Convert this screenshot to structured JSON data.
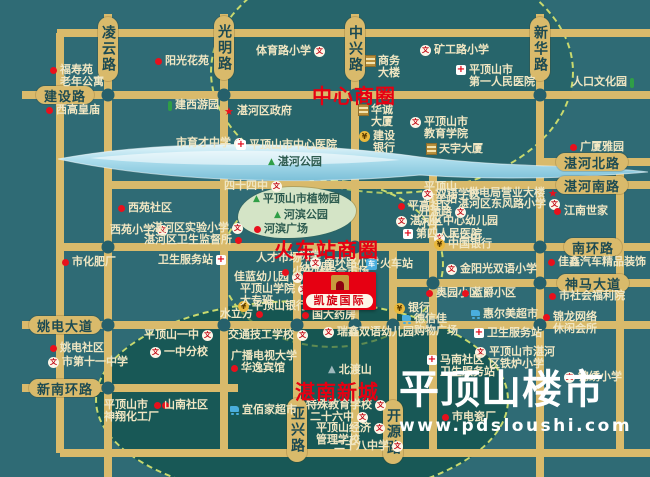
{
  "colors": {
    "background": "#2f6b75",
    "road": "#d9ba6b",
    "road_text": "#1c4a52",
    "label_text": "#f0e6c2",
    "accent_red": "#e60012",
    "river": "#a8d8ea",
    "park_green": "#d4e4c6",
    "zone_dash": "#c9da6e"
  },
  "project": {
    "name": "凯旋国际"
  },
  "logo": {
    "title": "平顶山楼市",
    "url": "www.pdsloushi.com"
  },
  "business_zones": [
    {
      "label": "中心商圈",
      "x": 312,
      "y": 80
    },
    {
      "label": "火车站商圈",
      "x": 274,
      "y": 234
    },
    {
      "label": "湛南新城",
      "x": 295,
      "y": 376
    }
  ],
  "road_labels": [
    {
      "text": "凌云路",
      "dir": "v",
      "x": 108,
      "y": 49
    },
    {
      "text": "光明路",
      "dir": "v",
      "x": 224,
      "y": 48
    },
    {
      "text": "中兴路",
      "dir": "v",
      "x": 355,
      "y": 49
    },
    {
      "text": "新华路",
      "dir": "v",
      "x": 540,
      "y": 49
    },
    {
      "text": "亚兴路",
      "dir": "v",
      "x": 297,
      "y": 430
    },
    {
      "text": "开源路",
      "dir": "v",
      "x": 393,
      "y": 432
    },
    {
      "text": "建设路",
      "dir": "h",
      "x": 65,
      "y": 95
    },
    {
      "text": "姚电大道",
      "dir": "h",
      "x": 65,
      "y": 325
    },
    {
      "text": "新南环路",
      "dir": "h",
      "x": 65,
      "y": 388
    },
    {
      "text": "湛河北路",
      "dir": "h",
      "x": 592,
      "y": 162
    },
    {
      "text": "湛河南路",
      "dir": "h",
      "x": 592,
      "y": 185
    },
    {
      "text": "南环路",
      "dir": "h",
      "x": 593,
      "y": 247
    },
    {
      "text": "神马大道",
      "dir": "h",
      "x": 593,
      "y": 283
    }
  ],
  "landmarks": [
    {
      "x": 155,
      "y": 55,
      "icon": "dot",
      "lines": [
        "阳光花苑"
      ]
    },
    {
      "x": 50,
      "y": 64,
      "icon": "dot",
      "lines": [
        "福寿苑",
        "老年公寓"
      ]
    },
    {
      "x": 46,
      "y": 104,
      "icon": "dot",
      "lines": [
        "西高皇庙"
      ]
    },
    {
      "x": 168,
      "y": 99,
      "icon": "park",
      "lines": [
        "建西游园"
      ]
    },
    {
      "x": 176,
      "y": 137,
      "icon": "school",
      "side": "r",
      "lines": [
        "市育才中学"
      ]
    },
    {
      "x": 224,
      "y": 105,
      "icon": "star",
      "lines": [
        "湛河区政府"
      ]
    },
    {
      "x": 256,
      "y": 45,
      "icon": "school",
      "side": "r",
      "lines": [
        "体育路小学"
      ]
    },
    {
      "x": 236,
      "y": 139,
      "icon": "hosp",
      "lines": [
        "平顶山市中心医院"
      ]
    },
    {
      "x": 366,
      "y": 55,
      "icon": "bldg",
      "lines": [
        "商务",
        "大楼"
      ]
    },
    {
      "x": 359,
      "y": 104,
      "icon": "bldg",
      "lines": [
        "华诚",
        "大厦"
      ]
    },
    {
      "x": 359,
      "y": 130,
      "icon": "bank",
      "lines": [
        "建设",
        "银行"
      ]
    },
    {
      "x": 410,
      "y": 116,
      "icon": "school",
      "lines": [
        "平顶山市",
        "教育学院"
      ]
    },
    {
      "x": 427,
      "y": 143,
      "icon": "bldg",
      "lines": [
        "天宇大厦"
      ]
    },
    {
      "x": 420,
      "y": 44,
      "icon": "school",
      "lines": [
        "矿工路小学"
      ]
    },
    {
      "x": 456,
      "y": 64,
      "icon": "hosp",
      "lines": [
        "平顶山市",
        "第一人民医院"
      ]
    },
    {
      "x": 572,
      "y": 76,
      "icon": "park",
      "side": "r",
      "lines": [
        "人口文化园"
      ]
    },
    {
      "x": 570,
      "y": 141,
      "icon": "dot",
      "lines": [
        "广厦雅园"
      ]
    },
    {
      "x": 118,
      "y": 202,
      "icon": "dot",
      "lines": [
        "西苑社区"
      ]
    },
    {
      "x": 110,
      "y": 224,
      "icon": "school",
      "side": "r",
      "lines": [
        "西苑小学"
      ]
    },
    {
      "x": 152,
      "y": 222,
      "icon": "school",
      "side": "r",
      "lines": [
        "湛河区实验小学"
      ]
    },
    {
      "x": 144,
      "y": 234,
      "icon": "dot",
      "side": "r",
      "lines": [
        "湛河区卫生监督所"
      ]
    },
    {
      "x": 158,
      "y": 254,
      "icon": "hosp",
      "side": "r",
      "lines": [
        "卫生服务站"
      ]
    },
    {
      "x": 62,
      "y": 256,
      "icon": "dot",
      "lines": [
        "市化肥厂"
      ]
    },
    {
      "x": 224,
      "y": 180,
      "icon": "school",
      "side": "r",
      "lines": [
        "四十四中"
      ]
    },
    {
      "x": 268,
      "y": 156,
      "icon": "tree",
      "dark": true,
      "lines": [
        "湛河公园"
      ]
    },
    {
      "x": 253,
      "y": 193,
      "icon": "tree",
      "dark": true,
      "lines": [
        "平顶山市植物园"
      ]
    },
    {
      "x": 274,
      "y": 209,
      "icon": "tree",
      "dark": true,
      "lines": [
        "河滨公园"
      ]
    },
    {
      "x": 254,
      "y": 223,
      "icon": "dot",
      "dark": true,
      "lines": [
        "河滨广场"
      ]
    },
    {
      "x": 424,
      "y": 181,
      "icon": "none",
      "lines": [
        "平顶山",
        "汽车站"
      ]
    },
    {
      "x": 419,
      "y": 206,
      "icon": "school",
      "side": "r",
      "lines": [
        "开源路",
        "小学"
      ]
    },
    {
      "x": 434,
      "y": 232,
      "icon": "school",
      "lines": [
        "十三中"
      ]
    },
    {
      "x": 422,
      "y": 188,
      "icon": "school",
      "lines": [
        "双语学校"
      ]
    },
    {
      "x": 398,
      "y": 200,
      "icon": "dot",
      "lines": [
        "平高社区"
      ]
    },
    {
      "x": 468,
      "y": 187,
      "icon": "star",
      "side": "r",
      "lines": [
        "供电局营业大楼"
      ]
    },
    {
      "x": 458,
      "y": 198,
      "icon": "school",
      "side": "r",
      "lines": [
        "湛河区东风路小学"
      ]
    },
    {
      "x": 396,
      "y": 215,
      "icon": "school",
      "lines": [
        "湛河区中心幼儿园"
      ]
    },
    {
      "x": 403,
      "y": 228,
      "icon": "hosp",
      "lines": [
        "第四人民医院"
      ]
    },
    {
      "x": 434,
      "y": 238,
      "icon": "bank",
      "lines": [
        "中国银行"
      ]
    },
    {
      "x": 554,
      "y": 205,
      "icon": "dot",
      "lines": [
        "江南世家"
      ]
    },
    {
      "x": 446,
      "y": 263,
      "icon": "school",
      "lines": [
        "金阳光双语小学"
      ]
    },
    {
      "x": 548,
      "y": 256,
      "icon": "dot",
      "lines": [
        "佳鑫汽车精品装饰"
      ]
    },
    {
      "x": 426,
      "y": 287,
      "icon": "dot",
      "lines": [
        "奥园小区"
      ]
    },
    {
      "x": 462,
      "y": 287,
      "icon": "dot",
      "lines": [
        "蓝爵小区"
      ]
    },
    {
      "x": 549,
      "y": 290,
      "icon": "dot",
      "lines": [
        "市社会福利院"
      ]
    },
    {
      "x": 543,
      "y": 311,
      "icon": "dot",
      "lines": [
        "锦龙网络",
        "休闲会所"
      ]
    },
    {
      "x": 471,
      "y": 308,
      "icon": "cart",
      "lines": [
        "惠尔美超市"
      ]
    },
    {
      "x": 474,
      "y": 327,
      "icon": "hosp",
      "lines": [
        "卫生服务站"
      ]
    },
    {
      "x": 475,
      "y": 346,
      "icon": "school",
      "lines": [
        "平顶山市湛河",
        "区铁炉小学"
      ]
    },
    {
      "x": 427,
      "y": 354,
      "icon": "hosp",
      "lines": [
        "马南社区",
        "卫生服务站"
      ]
    },
    {
      "x": 564,
      "y": 371,
      "icon": "school",
      "lines": [
        "锦绣小学"
      ]
    },
    {
      "x": 442,
      "y": 411,
      "icon": "dot",
      "lines": [
        "市电瓷厂"
      ]
    },
    {
      "x": 394,
      "y": 302,
      "icon": "bank",
      "lines": [
        "银行"
      ]
    },
    {
      "x": 402,
      "y": 313,
      "icon": "cart",
      "lines": [
        "德信佳",
        "购物广场"
      ]
    },
    {
      "x": 220,
      "y": 308,
      "icon": "dot",
      "side": "r",
      "lines": [
        "水立方"
      ]
    },
    {
      "x": 238,
      "y": 300,
      "icon": "bank",
      "lines": [
        "平顶山银行"
      ]
    },
    {
      "x": 302,
      "y": 309,
      "icon": "dot",
      "lines": [
        "国大药房"
      ]
    },
    {
      "x": 228,
      "y": 329,
      "icon": "school",
      "side": "r",
      "lines": [
        "交通技工学校"
      ]
    },
    {
      "x": 323,
      "y": 326,
      "icon": "school",
      "lines": [
        "瑞鑫双语幼儿园"
      ]
    },
    {
      "x": 231,
      "y": 350,
      "icon": "none",
      "lines": [
        "广播电视大学"
      ]
    },
    {
      "x": 231,
      "y": 362,
      "icon": "dot",
      "lines": [
        "华逸宾馆"
      ]
    },
    {
      "x": 328,
      "y": 364,
      "icon": "mtn",
      "lines": [
        "北渡山"
      ]
    },
    {
      "x": 306,
      "y": 399,
      "icon": "school",
      "side": "r",
      "lines": [
        "特殊教育学校"
      ]
    },
    {
      "x": 310,
      "y": 411,
      "icon": "school",
      "side": "r",
      "lines": [
        "二十六中"
      ]
    },
    {
      "x": 316,
      "y": 422,
      "icon": "school",
      "side": "r",
      "lines": [
        "平顶山经济",
        "管理学校"
      ]
    },
    {
      "x": 334,
      "y": 440,
      "icon": "school",
      "side": "r",
      "lines": [
        "二十八中学"
      ]
    },
    {
      "x": 230,
      "y": 404,
      "icon": "cart",
      "lines": [
        "宜佰家超市"
      ]
    },
    {
      "x": 50,
      "y": 342,
      "icon": "dot",
      "lines": [
        "姚电社区"
      ]
    },
    {
      "x": 48,
      "y": 356,
      "icon": "school",
      "lines": [
        "市第十一中学"
      ]
    },
    {
      "x": 144,
      "y": 329,
      "icon": "school",
      "side": "r",
      "lines": [
        "平顶山一中"
      ]
    },
    {
      "x": 150,
      "y": 346,
      "icon": "school",
      "lines": [
        "一中分校"
      ]
    },
    {
      "x": 104,
      "y": 399,
      "icon": "dot",
      "side": "r",
      "lines": [
        "平顶山市",
        "神翔化工厂"
      ]
    },
    {
      "x": 154,
      "y": 399,
      "icon": "dot",
      "lines": [
        "山南社区"
      ]
    },
    {
      "x": 256,
      "y": 252,
      "icon": "star",
      "side": "r",
      "lines": [
        "人才市场"
      ]
    },
    {
      "x": 299,
      "y": 250,
      "icon": "none",
      "lines": [
        "树棠",
        "幼儿园"
      ]
    },
    {
      "x": 234,
      "y": 271,
      "icon": "school",
      "side": "r",
      "lines": [
        "佳蓝幼儿园"
      ]
    },
    {
      "x": 240,
      "y": 283,
      "icon": "school",
      "side": "r",
      "lines": [
        "平顶山学院",
        "大专班"
      ]
    },
    {
      "x": 310,
      "y": 257,
      "icon": "school",
      "lines": [
        "南环路小学"
      ]
    },
    {
      "x": 366,
      "y": 258,
      "icon": "train",
      "lines": [
        "火车站"
      ]
    },
    {
      "x": 282,
      "y": 266,
      "icon": "dot",
      "lines": [
        "火车站综合市场"
      ]
    }
  ]
}
